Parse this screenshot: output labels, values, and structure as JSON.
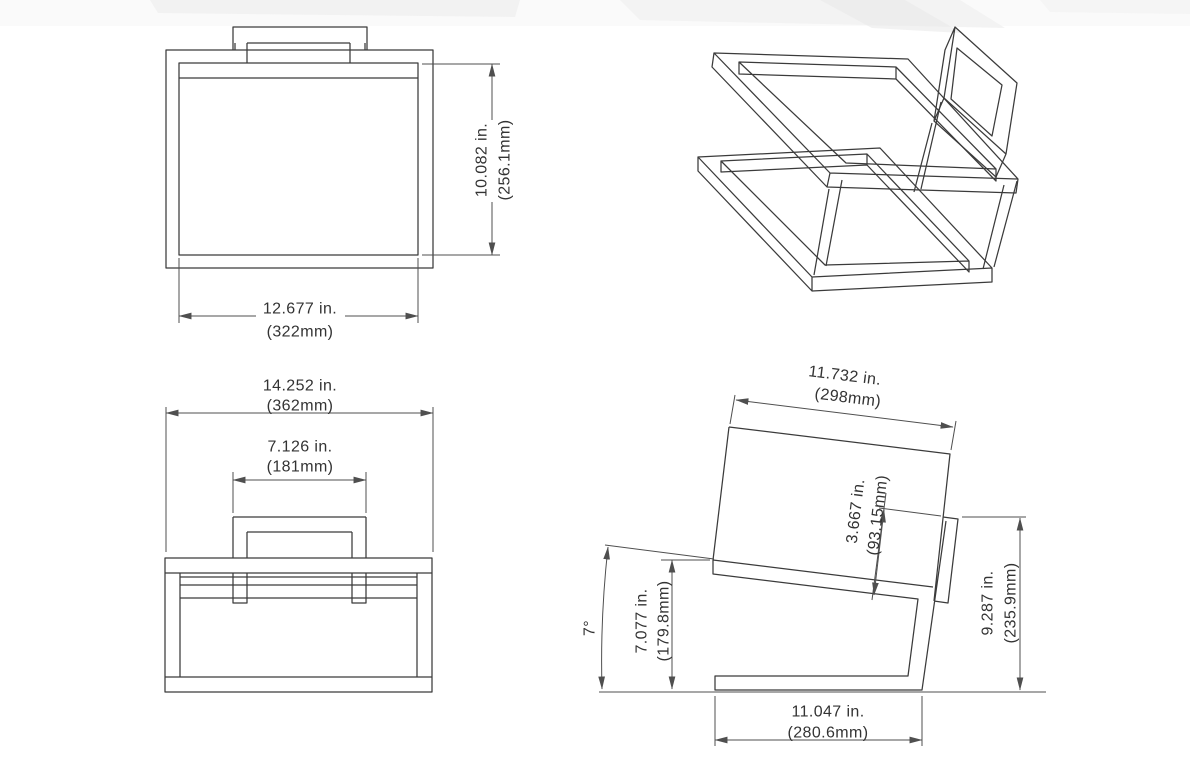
{
  "page": {
    "background": "#ffffff"
  },
  "drawing": {
    "line_color": "#3b3b3b",
    "dim_color": "#4f4f4f",
    "text_color": "#333333",
    "views": {
      "top": {
        "width": {
          "in": "12.677 in.",
          "mm": "(322mm)"
        },
        "height": {
          "in": "10.082 in.",
          "mm": "(256.1mm)"
        }
      },
      "isometric": {},
      "front": {
        "overall_width": {
          "in": "14.252 in.",
          "mm": "(362mm)"
        },
        "backrest_width": {
          "in": "7.126 in.",
          "mm": "(181mm)"
        }
      },
      "side": {
        "seat_depth": {
          "in": "11.732 in.",
          "mm": "(298mm)"
        },
        "backrest_height": {
          "in": "3.667 in.",
          "mm": "(93.15mm)"
        },
        "seat_angle": "7°",
        "front_height": {
          "in": "7.077 in.",
          "mm": "(179.8mm)"
        },
        "overall_height": {
          "in": "9.287 in.",
          "mm": "(235.9mm)"
        },
        "base_depth": {
          "in": "11.047 in.",
          "mm": "(280.6mm)"
        }
      }
    }
  }
}
